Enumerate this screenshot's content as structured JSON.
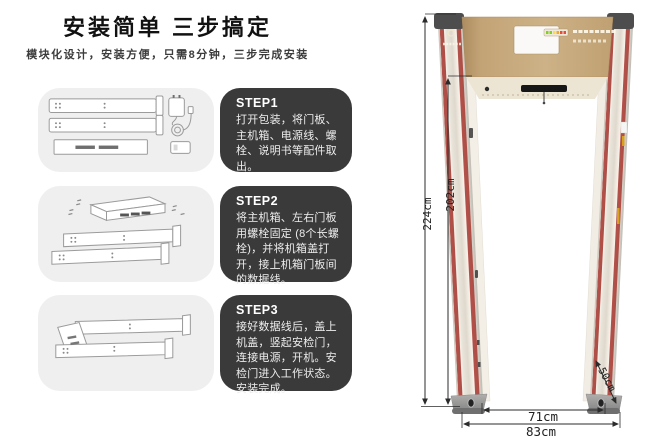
{
  "header": {
    "title": "安装简单 三步搞定",
    "subtitle": "模块化设计，安装方便，只需8分钟，三步完成安装"
  },
  "steps": [
    {
      "label": "STEP1",
      "text": "打开包装，将门板、主机箱、电源线、螺栓、说明书等配件取出。"
    },
    {
      "label": "STEP2",
      "text": "将主机箱、左右门板用螺栓固定 (8个长螺栓)，并将机箱盖打开，接上机箱门板间的数据线。"
    },
    {
      "label": "STEP3",
      "text": "接好数据线后，盖上机盖，竖起安检门，连接电源，开机。安检门进入工作状态。安装完成。"
    }
  ],
  "diagram": {
    "outer_height": "224cm",
    "inner_height": "202cm",
    "base_depth": "50cm",
    "inner_width": "71cm",
    "outer_width": "83cm"
  },
  "colors": {
    "accent_red": "#b2514a",
    "header_tan": "#c6a678",
    "panel_dark": "#3a3a3a",
    "panel_gray": "#efeff0"
  }
}
